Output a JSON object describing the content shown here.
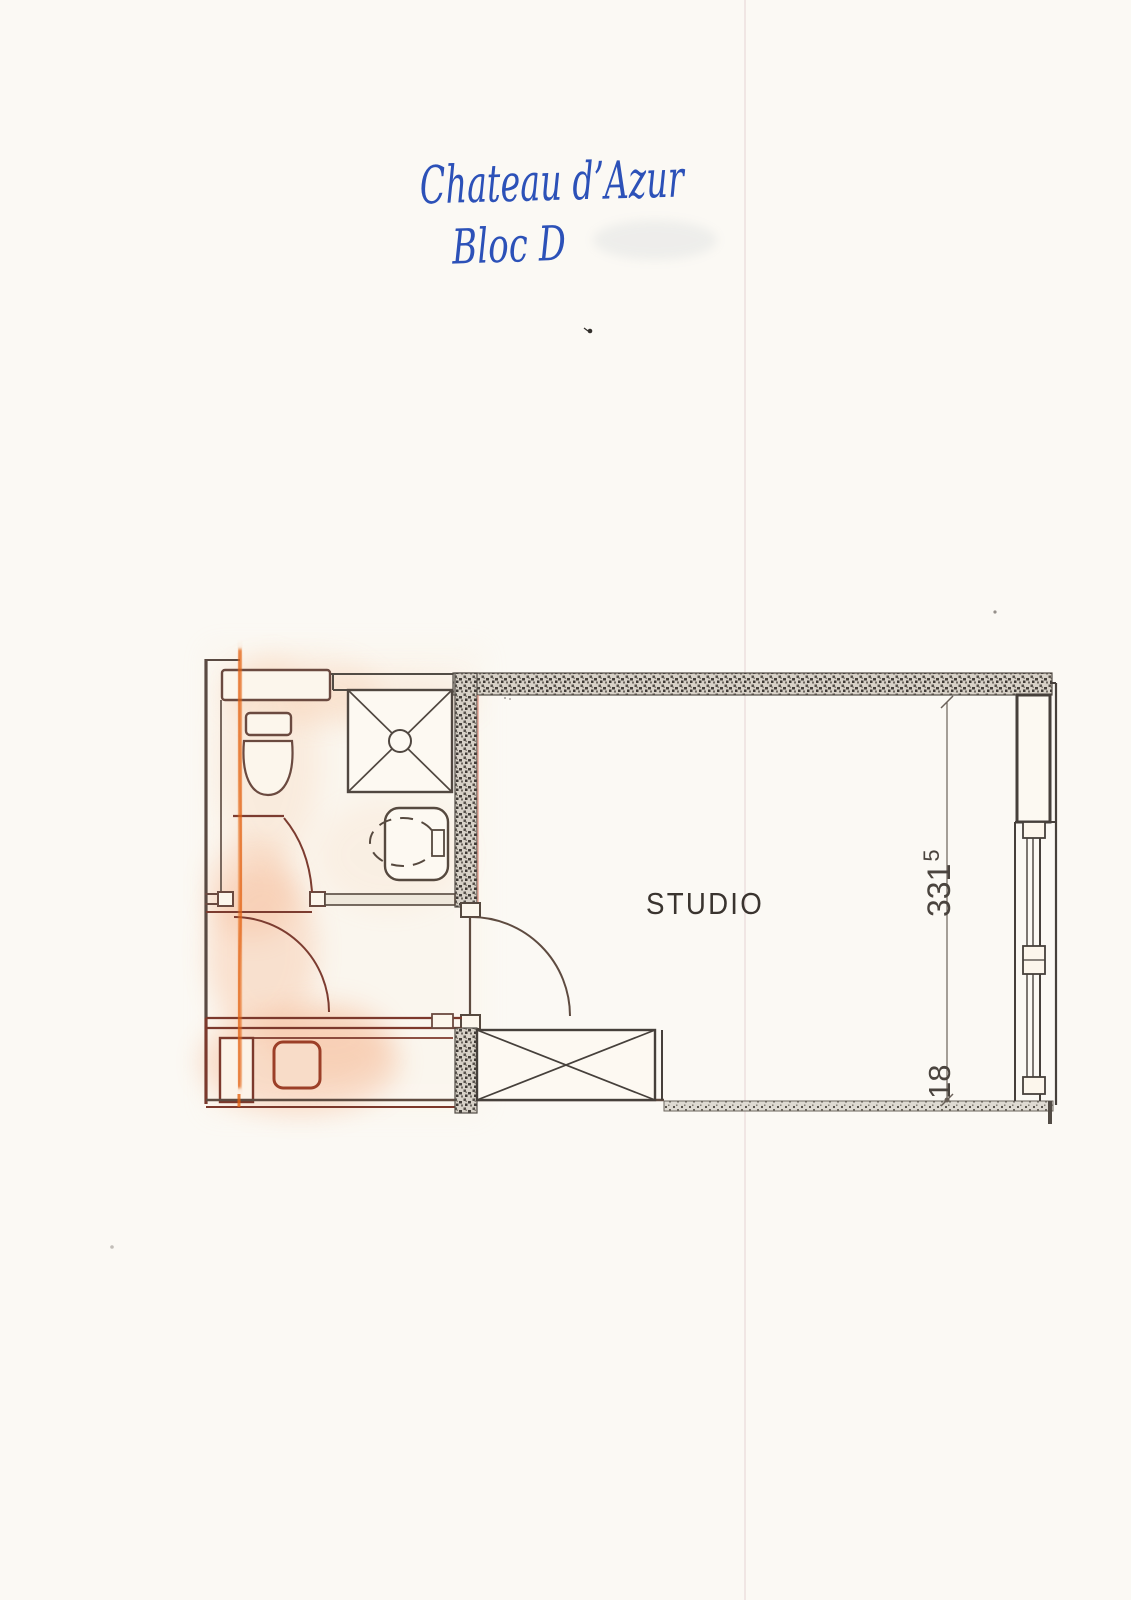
{
  "document": {
    "handwritten_title_line1": "Chateau d’Azur",
    "handwritten_title_line2": "Bloc D"
  },
  "floor_plan": {
    "room_label": "STUDIO",
    "dimensions": {
      "width_main": "331",
      "width_superscript": "5",
      "depth_label": "18"
    },
    "colors": {
      "ink_blue": "#2c51b8",
      "plan_line": "#46403b",
      "marker_orange": "#e2600e",
      "paper": "#fbf9f4"
    }
  }
}
